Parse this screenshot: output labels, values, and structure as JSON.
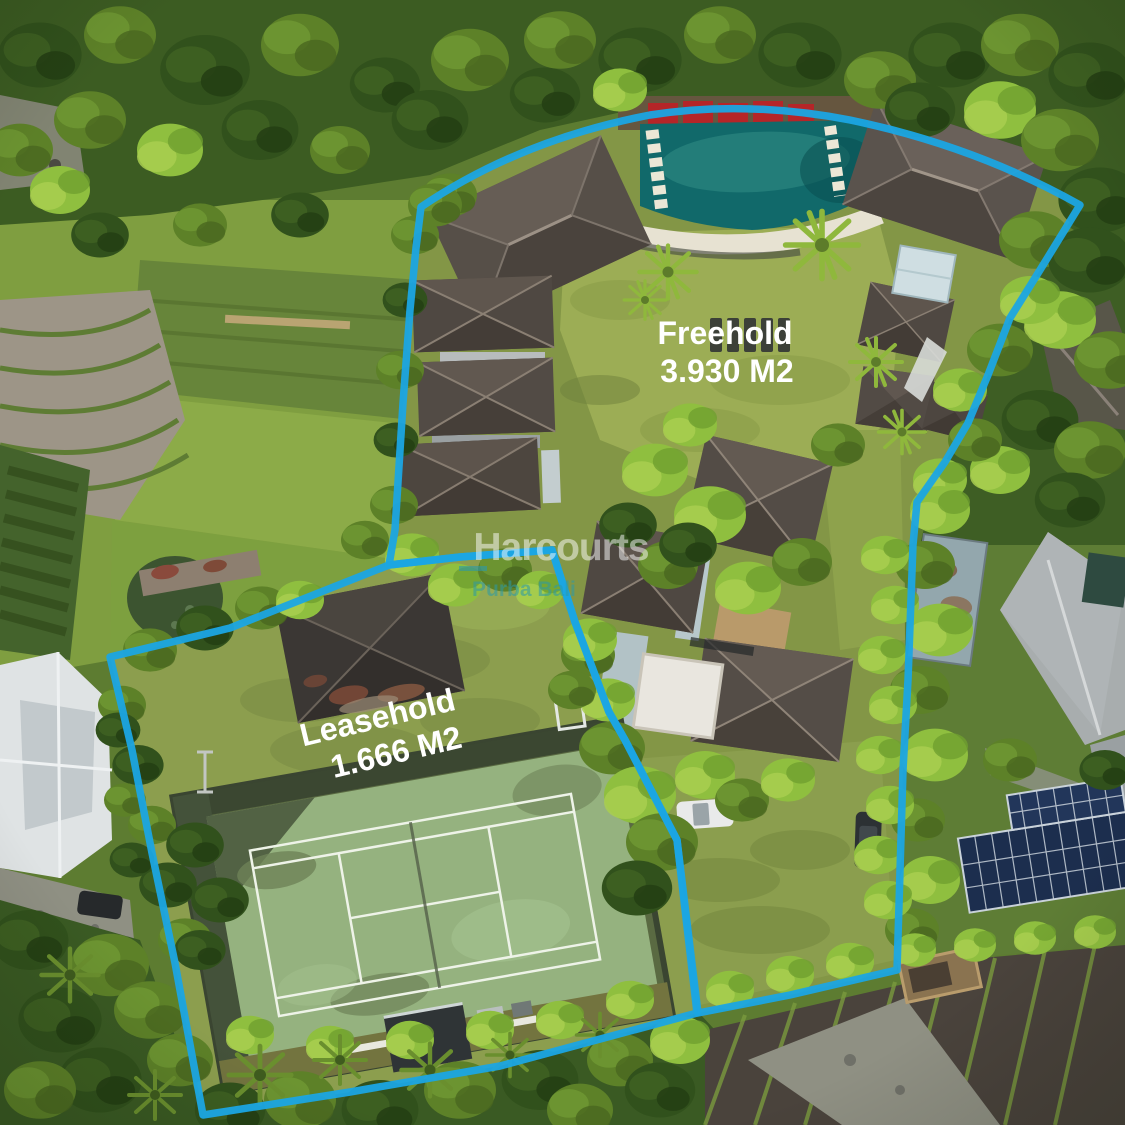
{
  "overlay": {
    "freehold": {
      "name": "Freehold",
      "area": "3.930 M2"
    },
    "leasehold": {
      "name": "Leasehold",
      "area": "1.666 M2"
    }
  },
  "watermark": {
    "brand": "Harcourts",
    "subtitle": "Purba Bali"
  },
  "colors": {
    "boundary": "#1ba5e3",
    "label_text": "#ffffff",
    "watermark_brand": "#ffffff",
    "watermark_subtitle": "#2b9aa8",
    "pool_water": "#11696a",
    "court_surface": "#95b27f",
    "umbrella_red": "#b52528"
  }
}
